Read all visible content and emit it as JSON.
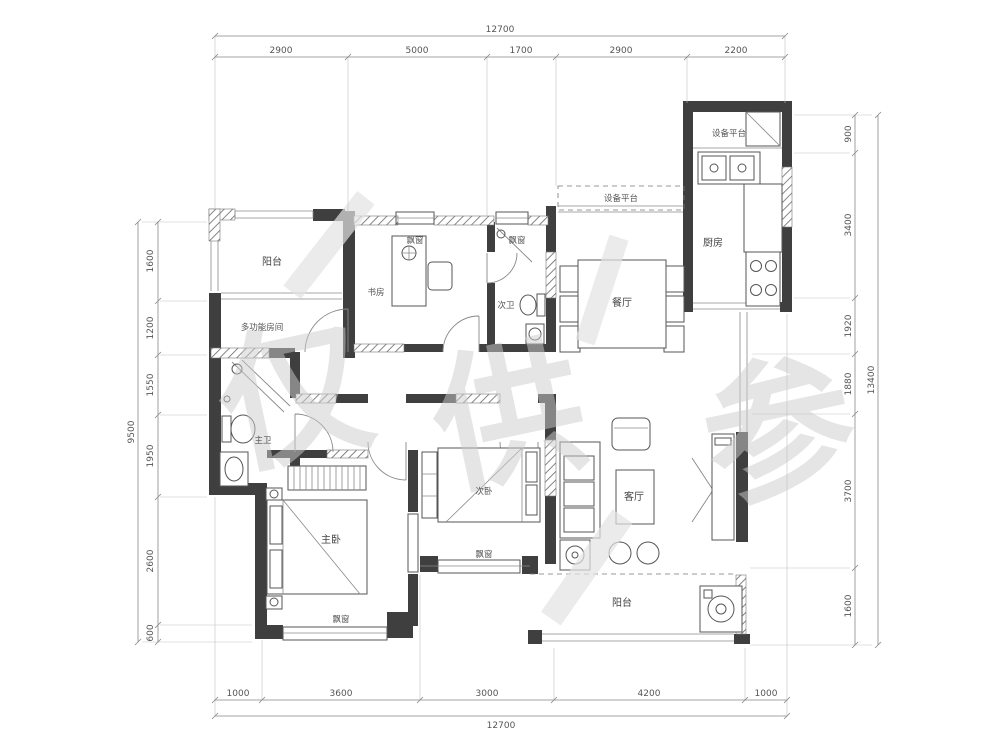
{
  "dims": {
    "top": {
      "total": "12700",
      "segments": [
        "2900",
        "5000",
        "1700",
        "2900",
        "2200"
      ]
    },
    "bottom": {
      "total": "12700",
      "segments": [
        "1000",
        "3600",
        "3000",
        "4200",
        "1000"
      ]
    },
    "left": {
      "total": "9500",
      "segments": [
        "1600",
        "1200",
        "1550",
        "1950",
        "2600",
        "600"
      ]
    },
    "right": {
      "total": "13400",
      "segments": [
        "900",
        "3400",
        "1920",
        "1880",
        "3700",
        "1600"
      ]
    }
  },
  "rooms": {
    "balcony_top": "阳台",
    "multi_room": "多功能房间",
    "master_bath": "主卫",
    "study": "书房",
    "second_bath": "次卫",
    "bay_window": "飘窗",
    "dining": "餐厅",
    "kitchen": "厨房",
    "equipment_platform": "设备平台",
    "living": "客厅",
    "second_bedroom": "次卧",
    "master_bedroom": "主卧",
    "balcony_bottom": "阳台"
  },
  "watermark": {
    "char1": "仅",
    "char2": "供",
    "char3": "参"
  },
  "colors": {
    "wall": "#3f3f3f",
    "dim_line": "#888888",
    "label": "#444444",
    "watermark": "#cdcdcd"
  }
}
